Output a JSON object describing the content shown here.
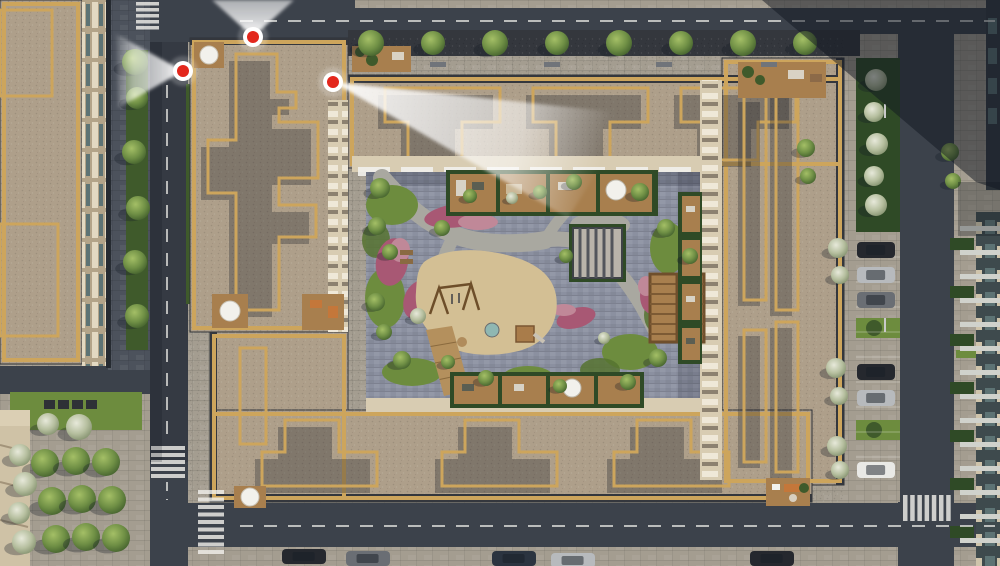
{
  "scene": {
    "description": "Aerial top-down 3D render of a residential block with gold-trimmed grey roofs around a landscaped inner courtyard (playground, terraces, pergolas), surrounding streets with crosswalks, street trees, parked cars, and three red viewpoint markers with white view cones"
  },
  "palette": {
    "asphalt": "#3c424b",
    "asphaltDark": "#353b44",
    "paver": "#a49d90",
    "shadowPave": "#4c525c",
    "roofTan": "#ae9f8a",
    "parapetGold": "#cda55c",
    "roofSlate": "#585b62",
    "roofGrayBrown": "#90897f",
    "darkBand": "#34373d",
    "darkWall": "#262b31",
    "facadeCream": "#d8ccb2",
    "facadeTeal": "#5d7374",
    "slab": "#d0d2cc",
    "courtStone": "#8b90a0",
    "pathStone": "#a9a8a0",
    "lawn": "#6d8c3e",
    "lawnDark": "#567330",
    "hedge": "#2f4a26",
    "bushStrip": "#3f5a2b",
    "sand": "#d3bf94",
    "wood": "#a87f4e",
    "woodBoard": "#b4905d",
    "lowrise": "#cfc2a6",
    "white": "#f2f1ec",
    "markerRed": "#e3271c",
    "shadow": "#161c26",
    "furnOrange": "#c4773a",
    "flowerMagenta": "#a85874",
    "flowerPink": "#c08898",
    "carDark": "#25282e",
    "carSilver": "#b7babd",
    "carGray": "#6a6e74",
    "carWhite": "#e9e9e6",
    "carNavy": "#2b3440"
  },
  "markers": [
    {
      "name": "viewpoint-marker-top",
      "x": 253,
      "y": 37,
      "cone": "253,37 212,0 294,0",
      "fade": [
        253,
        -20
      ]
    },
    {
      "name": "viewpoint-marker-left",
      "x": 183,
      "y": 71,
      "cone": "183,71 116,34 118,108",
      "fade": [
        112,
        70
      ]
    },
    {
      "name": "viewpoint-marker-right",
      "x": 333,
      "y": 82,
      "cone": "333,82 634,114 568,218",
      "fade": [
        604,
        152
      ]
    }
  ],
  "crosswalks": [
    {
      "name": "crosswalk-top-left",
      "x": 136,
      "y": 2,
      "w": 23,
      "h": 3.5,
      "dx": 0,
      "dy": 6,
      "count": 5
    },
    {
      "name": "crosswalk-left-road",
      "x": 151,
      "y": 446,
      "w": 34,
      "h": 4,
      "dx": 0,
      "dy": 7,
      "count": 5
    },
    {
      "name": "crosswalk-bottom-road",
      "x": 198,
      "y": 490,
      "w": 26,
      "h": 4,
      "dx": 0,
      "dy": 7.5,
      "count": 9
    },
    {
      "name": "crosswalk-right-road",
      "x": 903,
      "y": 495,
      "w": 4.5,
      "h": 26,
      "dx": 7.2,
      "dy": 0,
      "count": 7
    }
  ],
  "trees": [
    {
      "name": "street-tree",
      "layer": "trees-top",
      "grad": "gTree",
      "items": [
        [
          371,
          43,
          13
        ],
        [
          433,
          43,
          12
        ],
        [
          495,
          43,
          13
        ],
        [
          557,
          43,
          12
        ],
        [
          619,
          43,
          13
        ],
        [
          681,
          43,
          12
        ],
        [
          743,
          43,
          13
        ],
        [
          805,
          43,
          12
        ]
      ]
    },
    {
      "name": "street-tree",
      "layer": "trees-left",
      "grad": "gTree",
      "items": [
        [
          135,
          62,
          13
        ],
        [
          137,
          98,
          11
        ],
        [
          134,
          152,
          12
        ],
        [
          138,
          208,
          12
        ],
        [
          135,
          262,
          12
        ],
        [
          137,
          316,
          12
        ]
      ]
    },
    {
      "name": "median-tree",
      "layer": "trees-median",
      "grad": "gTreeWhite",
      "items": [
        [
          876,
          80,
          11
        ],
        [
          874,
          112,
          10
        ],
        [
          877,
          144,
          11
        ],
        [
          874,
          176,
          10
        ],
        [
          876,
          205,
          11
        ]
      ]
    },
    {
      "name": "plaza-tree",
      "layer": "trees-plaza",
      "grad": "gTree",
      "items": [
        [
          45,
          463,
          14
        ],
        [
          76,
          461,
          14
        ],
        [
          106,
          462,
          14
        ],
        [
          52,
          501,
          14
        ],
        [
          82,
          499,
          14
        ],
        [
          112,
          500,
          14
        ],
        [
          56,
          539,
          14
        ],
        [
          86,
          537,
          14
        ],
        [
          116,
          538,
          14
        ]
      ]
    },
    {
      "name": "lawn-tree",
      "layer": "trees-plaza",
      "grad": "gTreeWhite",
      "items": [
        [
          48,
          424,
          11
        ],
        [
          79,
          427,
          13
        ]
      ]
    },
    {
      "name": "flowering-tree",
      "layer": "trees-west",
      "grad": "gTreeWhite",
      "items": [
        [
          20,
          455,
          11
        ],
        [
          25,
          484,
          12
        ],
        [
          19,
          513,
          11
        ],
        [
          24,
          542,
          12
        ]
      ]
    },
    {
      "name": "flowering-tree",
      "layer": "trees-east",
      "grad": "gTreeWhite",
      "items": [
        [
          838,
          248,
          10
        ],
        [
          840,
          275,
          9
        ],
        [
          836,
          368,
          10
        ],
        [
          839,
          396,
          9
        ],
        [
          837,
          446,
          10
        ],
        [
          840,
          470,
          9
        ]
      ]
    },
    {
      "name": "shrub",
      "layer": "trees-east",
      "grad": "gTree",
      "items": [
        [
          806,
          148,
          9
        ],
        [
          808,
          176,
          8
        ],
        [
          950,
          152,
          9
        ],
        [
          953,
          181,
          8
        ]
      ]
    },
    {
      "name": "courtyard-tree",
      "layer": "trees-court",
      "grad": "gTree",
      "items": [
        [
          380,
          188,
          10
        ],
        [
          377,
          226,
          9
        ],
        [
          390,
          252,
          8
        ],
        [
          376,
          302,
          9
        ],
        [
          384,
          332,
          8
        ],
        [
          402,
          360,
          9
        ],
        [
          442,
          228,
          8
        ],
        [
          470,
          196,
          7
        ],
        [
          540,
          192,
          7
        ],
        [
          574,
          182,
          8
        ],
        [
          640,
          192,
          9
        ],
        [
          566,
          256,
          7
        ],
        [
          666,
          228,
          9
        ],
        [
          690,
          256,
          8
        ],
        [
          658,
          358,
          9
        ],
        [
          628,
          382,
          8
        ],
        [
          560,
          386,
          7
        ],
        [
          486,
          378,
          8
        ],
        [
          448,
          362,
          7
        ]
      ]
    },
    {
      "name": "flowering-shrub",
      "layer": "trees-court",
      "grad": "gTreeWhite",
      "items": [
        [
          418,
          316,
          8
        ],
        [
          512,
          198,
          6
        ],
        [
          604,
          338,
          6
        ]
      ]
    }
  ],
  "cars": [
    {
      "name": "parked-car",
      "layer": "cars-parking",
      "w": 38,
      "h": 16,
      "items": [
        [
          857,
          242,
          "carDark"
        ],
        [
          857,
          267,
          "carSilver"
        ],
        [
          857,
          292,
          "carGray"
        ],
        [
          857,
          364,
          "carDark"
        ],
        [
          857,
          390,
          "carSilver"
        ],
        [
          857,
          462,
          "carWhite"
        ]
      ]
    },
    {
      "name": "street-car",
      "layer": "cars-street",
      "w": 44,
      "h": 15,
      "items": [
        [
          282,
          549,
          "carDark"
        ],
        [
          346,
          551,
          "carGray"
        ],
        [
          492,
          551,
          "carNavy"
        ],
        [
          551,
          553,
          "carSilver"
        ],
        [
          750,
          551,
          "carDark"
        ]
      ]
    }
  ],
  "benches": {
    "top_walk": {
      "y": 62,
      "w": 16,
      "h": 5,
      "color": "#70747a",
      "xs": [
        430,
        544,
        656,
        761
      ]
    },
    "plaza_cubes": {
      "y": 400,
      "w": 11,
      "h": 9,
      "color": "#2e3136",
      "xs": [
        44,
        58,
        72,
        86
      ]
    }
  },
  "parking_lines": {
    "x": 856,
    "w": 44,
    "y0": 257,
    "step": 25,
    "n": 9
  },
  "awnings": {
    "x0": 358,
    "step": 43,
    "n": 8,
    "y": 167,
    "w": 32,
    "h": 9
  },
  "right_building": {
    "slabs": {
      "x": 960,
      "w": 40,
      "h": 5,
      "y0": 226,
      "step": 24,
      "n": 14
    },
    "hedges": {
      "x": 950,
      "w": 24,
      "h": 12,
      "y0": 238,
      "step": 48,
      "n": 7
    }
  }
}
